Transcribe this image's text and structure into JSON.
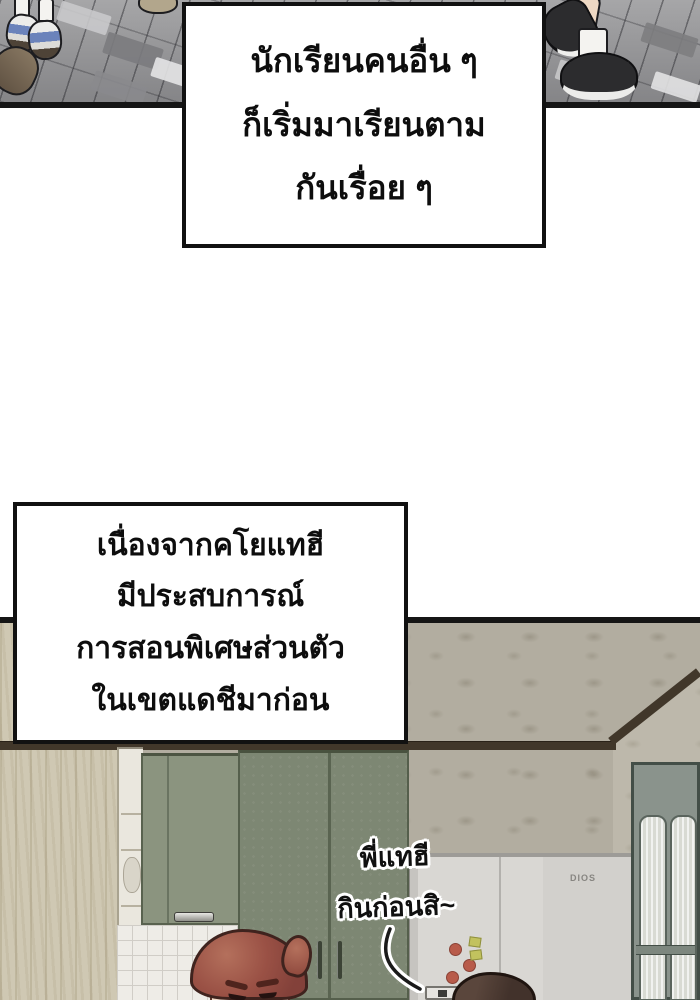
{
  "panel1": {
    "narration": {
      "line1": "นักเรียนคนอื่น ๆ",
      "line2": "ก็เริ่มมาเรียนตาม",
      "line3": "กันเรื่อย ๆ"
    }
  },
  "panel2": {
    "narration": {
      "line1": "เนื่องจากคโยแทฮี",
      "line2": "มีประสบการณ์",
      "line3": "การสอนพิเศษส่วนตัว",
      "line4": "ในเขตแดชีมาก่อน"
    },
    "speech": {
      "line1": "พี่แทฮี",
      "line2": "กินก่อนสิ~"
    },
    "fridge_brand": "DIOS"
  },
  "colors": {
    "panel_border": "#151515",
    "pavement_gray": "#9c9c9e",
    "sneaker_blue": "#6b83bb",
    "cabinet_green_tall": "#7d8773",
    "cabinet_green_upper": "#8b947f",
    "wallpaper_left": "#cfc8b3",
    "wallpaper_floral": "#b2ada0",
    "ceiling_trim_brown": "#41372a",
    "fridge_gray": "#d9d7d3",
    "magnet_red": "#b85b4a",
    "magnet_green": "#c2c25e",
    "hair_auburn": "#9a5145",
    "hair_dark_brown": "#42322b",
    "skin": "#f3dcc9"
  }
}
